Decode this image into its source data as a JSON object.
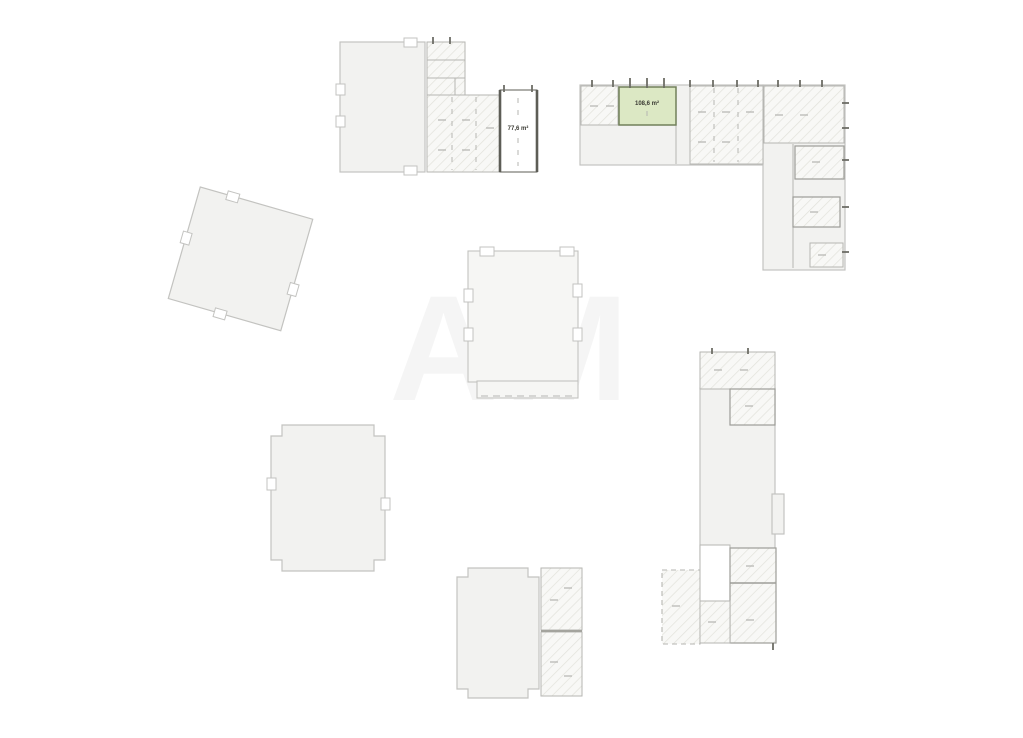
{
  "canvas": {
    "background": "#ffffff"
  },
  "watermark": {
    "text": "AM"
  },
  "units": {
    "highlighted": {
      "label": "108,6 m²",
      "status": "available"
    },
    "outlined": {
      "label": "77,6 m²"
    }
  },
  "colors": {
    "background": "#ffffff",
    "building_fill": "#f2f2f0",
    "building_fill_light": "#f6f6f4",
    "building_stroke": "#c3c3c0",
    "hatch_fill": "#f8f8f6",
    "hatch_line": "#e2e2db",
    "wall_light": "#b6b6b2",
    "wall_mid": "#9d9d98",
    "wall_dark": "#6d6d66",
    "door_dash": "#b4b4b0",
    "available_fill": "#dce8c4",
    "available_stroke": "#71805a",
    "outlined_unit_border": "#5d5d56",
    "label_text": "#3a3a33",
    "watermark_color": "#2a2a2a"
  }
}
